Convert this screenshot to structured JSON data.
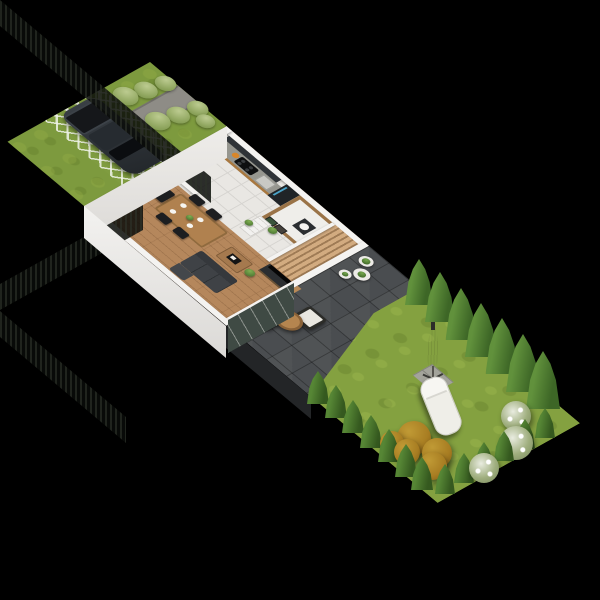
{
  "scene": {
    "type": "isometric 3D floor plan render",
    "description": "ground floor cutaway of a terraced house with front yard, driveway, patio and long fenced garden on black background",
    "background": "#000000"
  },
  "palette": {
    "lawn": "#84a140",
    "front_lawn": "#7d9a3e",
    "patio_tile": "#4a4d50",
    "path": "#8e8c86",
    "wood_floor": "#b5875c",
    "tile_floor": "#e9e7e3",
    "wall": "#f4f3f1",
    "stairs_wood": "#c2a077",
    "cabinet_dark": "#2f3337",
    "cabinet_wood": "#a9783f",
    "fridge": "#202427",
    "sofa": "#3f4246",
    "table_wood": "#b0814f",
    "tree_green": "#4d7c2f",
    "bush_sage": "#9eb36b",
    "bush_autumn": "#a87d22",
    "fence": "#181b16",
    "car": "#2e3338",
    "cushion_white": "#e9e7e0",
    "glazing": "#454d49"
  },
  "front_yard": {
    "label": "front yard with sidewalk, hedge bushes, grass-grid driveway and parked dark SUV",
    "bushes_plan": [
      [
        28,
        8,
        10
      ],
      [
        24,
        30,
        11
      ],
      [
        19,
        52,
        12
      ],
      [
        68,
        6,
        10
      ],
      [
        64,
        28,
        11
      ],
      [
        59,
        50,
        12
      ],
      [
        84,
        12,
        9
      ]
    ]
  },
  "house": {
    "label": "ground floor cutaway",
    "rooms": [
      "kitchen",
      "wc",
      "hallway",
      "staircase",
      "dining area",
      "living room"
    ],
    "furniture": [
      "kitchen counter with cooktop and sink",
      "tall fridge",
      "dark upper cabinets",
      "dining table with four black chairs",
      "gray sofa with chaise",
      "wooden coffee table",
      "tv console with tv",
      "wooden staircase",
      "sliding glass door",
      "hall dresser",
      "potted plants"
    ]
  },
  "patio": {
    "label": "dark tiled terrace",
    "furniture": [
      "two armchairs with white cushions",
      "round wooden coffee table",
      "white planters"
    ],
    "planters_plan": [
      [
        6,
        10,
        14
      ],
      [
        15,
        25,
        16
      ],
      [
        8,
        40,
        12
      ]
    ]
  },
  "garden": {
    "label": "fenced lawn with conifers, parasol, sun lounger and shrubs",
    "fence_sides": [
      "back",
      "right",
      "front"
    ],
    "umbrella": {
      "x": 433,
      "y": 380
    },
    "lounger": {
      "x": 440,
      "y": 405,
      "angle": 68
    },
    "vegetation": [
      {
        "t": "tree",
        "x": 419,
        "y": 305,
        "w": 28,
        "h": 46
      },
      {
        "t": "tree",
        "x": 440,
        "y": 322,
        "w": 30,
        "h": 50
      },
      {
        "t": "tree",
        "x": 461,
        "y": 340,
        "w": 31,
        "h": 52
      },
      {
        "t": "tree",
        "x": 481,
        "y": 357,
        "w": 32,
        "h": 54
      },
      {
        "t": "tree",
        "x": 502,
        "y": 374,
        "w": 33,
        "h": 56
      },
      {
        "t": "tree",
        "x": 523,
        "y": 392,
        "w": 34,
        "h": 58
      },
      {
        "t": "tree",
        "x": 543,
        "y": 409,
        "w": 34,
        "h": 58
      },
      {
        "t": "cone",
        "x": 545,
        "y": 438,
        "w": 20,
        "h": 30
      },
      {
        "t": "cone",
        "x": 525,
        "y": 449,
        "w": 20,
        "h": 30
      },
      {
        "t": "cone",
        "x": 504,
        "y": 461,
        "w": 20,
        "h": 30
      },
      {
        "t": "cone",
        "x": 484,
        "y": 472,
        "w": 20,
        "h": 30
      },
      {
        "t": "cone",
        "x": 464,
        "y": 483,
        "w": 20,
        "h": 30
      },
      {
        "t": "cone",
        "x": 445,
        "y": 494,
        "w": 20,
        "h": 30
      },
      {
        "t": "cone",
        "x": 318,
        "y": 404,
        "w": 22,
        "h": 33
      },
      {
        "t": "cone",
        "x": 336,
        "y": 418,
        "w": 22,
        "h": 33
      },
      {
        "t": "cone",
        "x": 353,
        "y": 433,
        "w": 22,
        "h": 33
      },
      {
        "t": "cone",
        "x": 371,
        "y": 448,
        "w": 22,
        "h": 33
      },
      {
        "t": "cone",
        "x": 389,
        "y": 462,
        "w": 22,
        "h": 33
      },
      {
        "t": "cone",
        "x": 406,
        "y": 477,
        "w": 22,
        "h": 33
      },
      {
        "t": "cone",
        "x": 422,
        "y": 490,
        "w": 22,
        "h": 33
      },
      {
        "t": "bush-orange",
        "x": 414,
        "y": 455,
        "w": 34,
        "h": 34
      },
      {
        "t": "bush-orange",
        "x": 437,
        "y": 468,
        "w": 30,
        "h": 30
      },
      {
        "t": "bush-orange",
        "x": 407,
        "y": 465,
        "w": 26,
        "h": 26
      },
      {
        "t": "bush-orange",
        "x": 433,
        "y": 480,
        "w": 28,
        "h": 28
      },
      {
        "t": "bush-orange",
        "x": 392,
        "y": 455,
        "w": 24,
        "h": 24
      },
      {
        "t": "bush-white",
        "x": 516,
        "y": 431,
        "w": 30,
        "h": 30
      },
      {
        "t": "bush-white",
        "x": 516,
        "y": 460,
        "w": 34,
        "h": 34
      },
      {
        "t": "bush-white",
        "x": 484,
        "y": 483,
        "w": 30,
        "h": 30
      }
    ]
  }
}
